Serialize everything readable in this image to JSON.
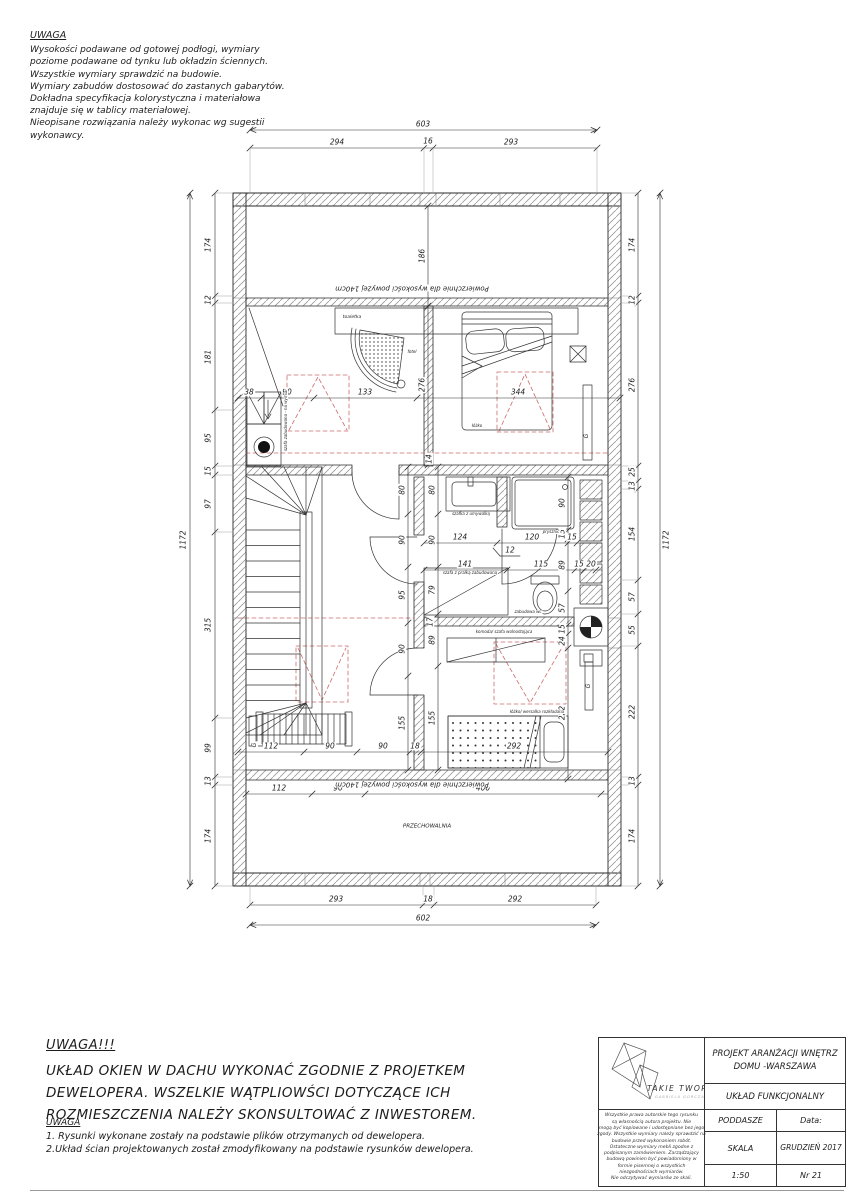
{
  "notes_top": {
    "title": "UWAGA",
    "lines": [
      "Wysokości podawane od gotowej podłogi, wymiary",
      "poziome podawane od tynku lub okładzin ściennych.",
      "Wszystkie wymiary sprawdzić na budowie.",
      "Wymiary zabudów dostosować do zastanych gabarytów.",
      "Dokładna specyfikacja kolorystyczna i materiałowa",
      "znajduje się w tablicy materiałowej.",
      "Nieopisane rozwiązania należy wykonac wg sugestii",
      "wykonawcy."
    ]
  },
  "big_note": {
    "title": "UWAGA!!!",
    "lines": [
      "UKŁAD OKIEN W DACHU WYKONAĆ ZGODNIE Z PROJETKEM",
      "DEWELOPERA. WSZELKIE WĄTPLIOWŚCI DOTYCZĄCE ICH",
      "ROZMIESZCZENIA NALEŻY SKONSULTOWAĆ Z INWESTOREM."
    ]
  },
  "small_note": {
    "title": "UWAGA",
    "lines": [
      "1. Rysunki wykonane zostały na podstawie plików otrzymanych od dewelopera.",
      "2.Układ ścian projektowanych został zmodyfikowany na podstawie rysunków dewelopera."
    ]
  },
  "title_block": {
    "brand": "TAKIE TWORY",
    "brand_sub": "GABRIELA GORCZAK",
    "project_line1": "PROJEKT ARANŻACJI WNĘTRZ",
    "project_line2": "DOMU -WARSZAWA",
    "drawing_name": "UKŁAD FUNKCJONALNY",
    "stage": "PODDASZE",
    "date_label": "Data:",
    "scale_label": "SKALA",
    "date_value": "GRUDZIEŃ 2017",
    "scale_value": "1:50",
    "sheet_no": "Nr 21",
    "disclaimer_lines": [
      "Wszystkie prawa autorskie tego rysunku",
      "są własnością autora projektu. Nie",
      "mogą być kopiowane i udostępniane bez jego",
      "zgody. Wszystkie wymiary należy sprawdzić na",
      "budowie przed wykonaniem robót.",
      "Ostateczne wymiary mebli zgodne z",
      "podpisanym zamówieniem. Zarządzający",
      "budową powinien być powiadomiony w",
      "formie pisemnej o wszystkich",
      "niezgodnościach wymiarów.",
      "Nie odczytywać wymiarów ze skali."
    ]
  },
  "plan": {
    "dim_labels": [
      {
        "t": "603",
        "x": 423,
        "y": 124
      },
      {
        "t": "294",
        "x": 337,
        "y": 142
      },
      {
        "t": "16",
        "x": 428,
        "y": 141
      },
      {
        "t": "293",
        "x": 511,
        "y": 142
      },
      {
        "t": "293",
        "x": 336,
        "y": 899
      },
      {
        "t": "18",
        "x": 428,
        "y": 899
      },
      {
        "t": "292",
        "x": 515,
        "y": 899
      },
      {
        "t": "602",
        "x": 423,
        "y": 918
      },
      {
        "t": "174",
        "x": 208,
        "y": 245,
        "r": -90
      },
      {
        "t": "12",
        "x": 208,
        "y": 300,
        "r": -90
      },
      {
        "t": "181",
        "x": 208,
        "y": 357,
        "r": -90
      },
      {
        "t": "95",
        "x": 208,
        "y": 438,
        "r": -90
      },
      {
        "t": "15",
        "x": 208,
        "y": 471,
        "r": -90
      },
      {
        "t": "97",
        "x": 208,
        "y": 504,
        "r": -90
      },
      {
        "t": "315",
        "x": 208,
        "y": 625,
        "r": -90
      },
      {
        "t": "99",
        "x": 208,
        "y": 748,
        "r": -90
      },
      {
        "t": "13",
        "x": 208,
        "y": 781,
        "r": -90
      },
      {
        "t": "174",
        "x": 208,
        "y": 836,
        "r": -90
      },
      {
        "t": "1172",
        "x": 183,
        "y": 540,
        "r": -90
      },
      {
        "t": "174",
        "x": 632,
        "y": 245,
        "r": -90
      },
      {
        "t": "12",
        "x": 632,
        "y": 300,
        "r": -90
      },
      {
        "t": "276",
        "x": 632,
        "y": 385,
        "r": -90
      },
      {
        "t": "25",
        "x": 632,
        "y": 472,
        "r": -90
      },
      {
        "t": "13",
        "x": 632,
        "y": 486,
        "r": -90
      },
      {
        "t": "154",
        "x": 632,
        "y": 534,
        "r": -90
      },
      {
        "t": "57",
        "x": 632,
        "y": 597,
        "r": -90
      },
      {
        "t": "55",
        "x": 632,
        "y": 630,
        "r": -90
      },
      {
        "t": "222",
        "x": 632,
        "y": 712,
        "r": -90
      },
      {
        "t": "13",
        "x": 632,
        "y": 781,
        "r": -90
      },
      {
        "t": "174",
        "x": 632,
        "y": 836,
        "r": -90
      },
      {
        "t": "1172",
        "x": 666,
        "y": 540,
        "r": -90
      },
      {
        "t": "186",
        "x": 422,
        "y": 256,
        "r": -90
      },
      {
        "t": "276",
        "x": 422,
        "y": 385,
        "r": -90
      },
      {
        "t": "38",
        "x": 249,
        "y": 392
      },
      {
        "t": "90",
        "x": 287,
        "y": 392
      },
      {
        "t": "133",
        "x": 365,
        "y": 392
      },
      {
        "t": "344",
        "x": 518,
        "y": 392
      },
      {
        "t": "14",
        "x": 429,
        "y": 459,
        "r": -90
      },
      {
        "t": "80",
        "x": 402,
        "y": 490,
        "r": -90
      },
      {
        "t": "90",
        "x": 402,
        "y": 540,
        "r": -90
      },
      {
        "t": "95",
        "x": 402,
        "y": 595,
        "r": -90
      },
      {
        "t": "90",
        "x": 402,
        "y": 649,
        "r": -90
      },
      {
        "t": "155",
        "x": 402,
        "y": 723,
        "r": -90
      },
      {
        "t": "80",
        "x": 432,
        "y": 490,
        "r": -90
      },
      {
        "t": "90",
        "x": 432,
        "y": 540,
        "r": -90
      },
      {
        "t": "79",
        "x": 432,
        "y": 590,
        "r": -90
      },
      {
        "t": "89",
        "x": 432,
        "y": 640,
        "r": -90
      },
      {
        "t": "155",
        "x": 432,
        "y": 718,
        "r": -90
      },
      {
        "t": "17",
        "x": 430,
        "y": 622,
        "r": -90
      },
      {
        "t": "90",
        "x": 562,
        "y": 503,
        "r": -90
      },
      {
        "t": "15",
        "x": 562,
        "y": 534,
        "r": -90
      },
      {
        "t": "89",
        "x": 562,
        "y": 565,
        "r": -90
      },
      {
        "t": "57",
        "x": 562,
        "y": 608,
        "r": -90
      },
      {
        "t": "15",
        "x": 562,
        "y": 629,
        "r": -90
      },
      {
        "t": "24",
        "x": 562,
        "y": 641,
        "r": -90
      },
      {
        "t": "222",
        "x": 562,
        "y": 713,
        "r": -90
      },
      {
        "t": "124",
        "x": 460,
        "y": 537
      },
      {
        "t": "120",
        "x": 532,
        "y": 537
      },
      {
        "t": "15",
        "x": 572,
        "y": 537
      },
      {
        "t": "12",
        "x": 510,
        "y": 550
      },
      {
        "t": "141",
        "x": 465,
        "y": 564
      },
      {
        "t": "115",
        "x": 541,
        "y": 564
      },
      {
        "t": "15",
        "x": 579,
        "y": 564
      },
      {
        "t": "20",
        "x": 591,
        "y": 564
      },
      {
        "t": "112",
        "x": 271,
        "y": 746
      },
      {
        "t": "90",
        "x": 330,
        "y": 746
      },
      {
        "t": "90",
        "x": 383,
        "y": 746
      },
      {
        "t": "18",
        "x": 415,
        "y": 746
      },
      {
        "t": "292",
        "x": 514,
        "y": 746
      },
      {
        "t": "112",
        "x": 279,
        "y": 788
      },
      {
        "t": "90",
        "x": 338,
        "y": 788
      },
      {
        "t": "400",
        "x": 483,
        "y": 788
      }
    ],
    "text_labels": [
      {
        "t": "Powierzchnie dla wysokości powyżej 140cm",
        "x": 412,
        "y": 288,
        "r": 180,
        "s": 7
      },
      {
        "t": "Powierzchnie dla wysokości powyżej 140cm",
        "x": 412,
        "y": 784,
        "r": 180,
        "s": 7
      },
      {
        "t": "toaletka",
        "x": 352,
        "y": 318,
        "s": 4.5
      },
      {
        "t": "fotel",
        "x": 412,
        "y": 352,
        "s": 4
      },
      {
        "t": "łóżko",
        "x": 477,
        "y": 426,
        "s": 4
      },
      {
        "t": "szafka z umywalką",
        "x": 471,
        "y": 514,
        "s": 4
      },
      {
        "t": "prysznic",
        "x": 551,
        "y": 532,
        "s": 4
      },
      {
        "t": "szafa z pralką zabudowaną",
        "x": 470,
        "y": 573,
        "s": 4
      },
      {
        "t": "zabudowa wc",
        "x": 528,
        "y": 612,
        "s": 4
      },
      {
        "t": "komoda/ szafa wolnostojąca",
        "x": 504,
        "y": 632,
        "s": 4
      },
      {
        "t": "łóżko/ wersalka rozkładana",
        "x": 537,
        "y": 712,
        "s": 4
      },
      {
        "t": "szafa zabudowana - na wymiar",
        "x": 286,
        "y": 420,
        "r": -90,
        "s": 4
      },
      {
        "t": "PRZECHOWALNIA",
        "x": 427,
        "y": 827,
        "s": 5.5
      },
      {
        "t": "G",
        "x": 587,
        "y": 436,
        "r": -90,
        "s": 6
      },
      {
        "t": "G",
        "x": 589,
        "y": 686,
        "r": -90,
        "s": 6
      },
      {
        "t": "G",
        "x": 255,
        "y": 745,
        "r": -90,
        "s": 6
      }
    ]
  }
}
